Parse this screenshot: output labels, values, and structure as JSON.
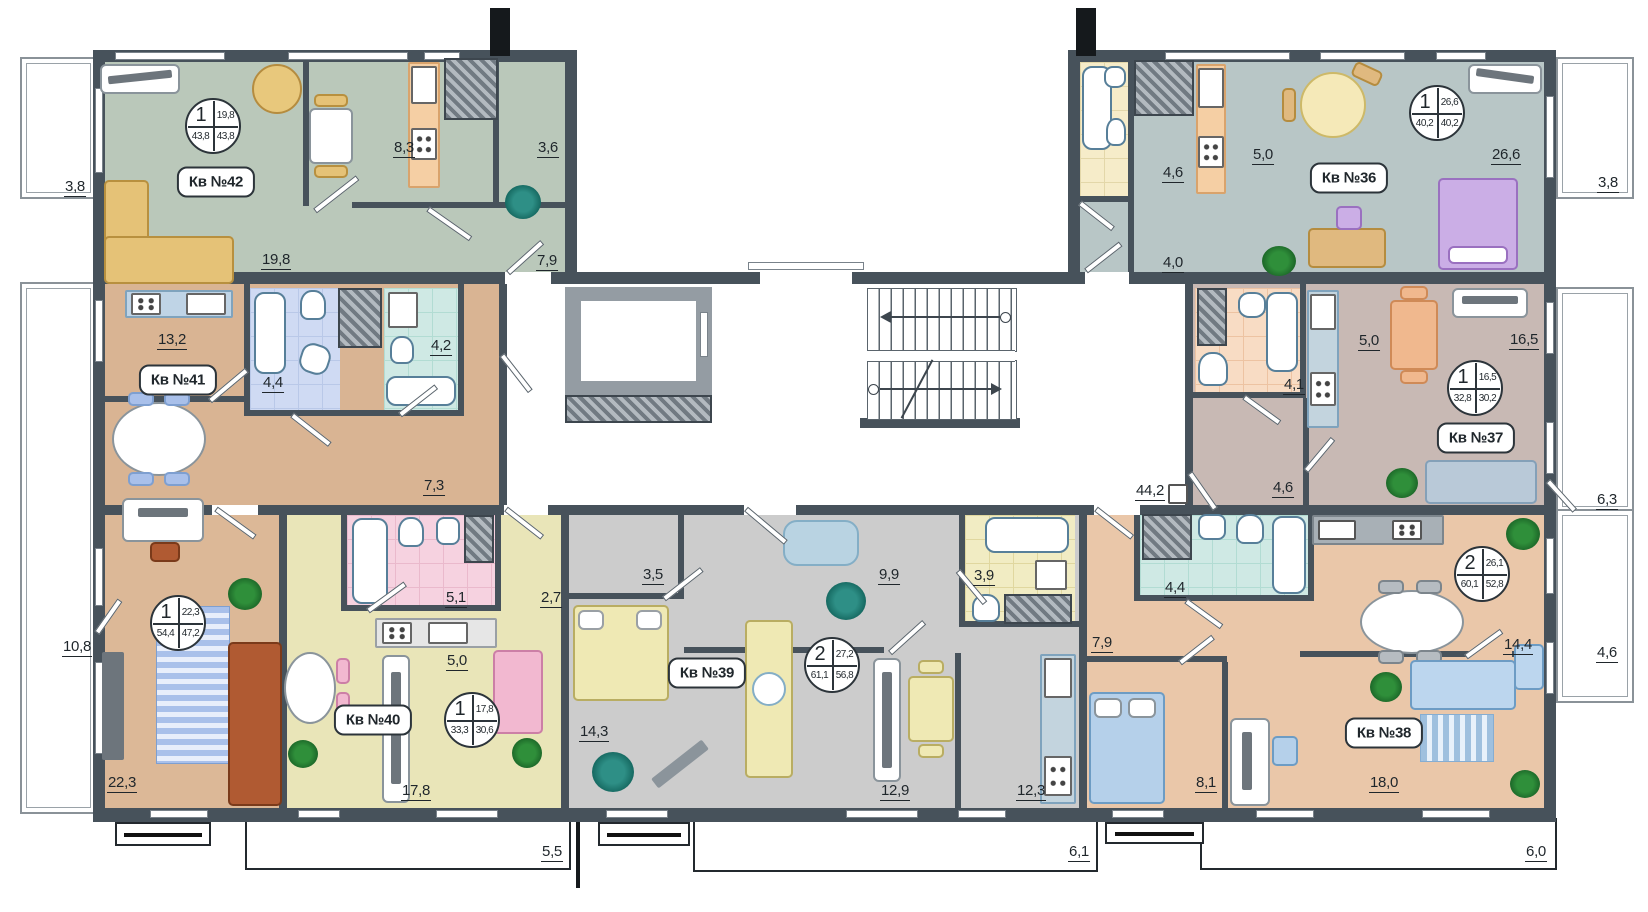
{
  "plan": {
    "title": "Floor plan with apartments 36-42",
    "colors": {
      "walls": "#47525b",
      "apt42_fill": "#bac8ba",
      "apt41_fill": "#d9b493",
      "apt40_fill": "#e9e5b8",
      "apt39_fill": "#cccccc",
      "apt38_fill": "#eac7a9",
      "apt37_fill": "#c8b9b4",
      "apt36_fill": "#b8c6c6"
    },
    "apartments": [
      {
        "badge": "Кв №42",
        "circle": {
          "rooms": "1",
          "living": "19,8",
          "total": "43,8",
          "reduced": "43,8"
        },
        "areas": {
          "living": "19,8",
          "kitchen": "8,3",
          "pantry": "3,6",
          "hall": "7,9"
        }
      },
      {
        "badge": "Кв №41",
        "circle": {
          "rooms": "1",
          "living": "22,3",
          "total": "54,4",
          "reduced": "47,2"
        },
        "areas": {
          "kitchen": "13,2",
          "bath": "4,4",
          "toilet": "4,2",
          "hall": "7,3",
          "living": "22,3"
        }
      },
      {
        "badge": "Кв №40",
        "circle": {
          "rooms": "1",
          "living": "17,8",
          "total": "33,3",
          "reduced": "30,6"
        },
        "areas": {
          "bath": "5,1",
          "hall": "2,7",
          "kitchen": "5,0",
          "living": "17,8"
        }
      },
      {
        "badge": "Кв №39",
        "circle": {
          "rooms": "2",
          "living": "27,2",
          "total": "61,1",
          "reduced": "56,8"
        },
        "areas": {
          "hall": "3,5",
          "corridor": "9,9",
          "bath": "3,9",
          "bedroom": "14,3",
          "living": "12,9",
          "kitchen": "12,3"
        }
      },
      {
        "badge": "Кв №38",
        "circle": {
          "rooms": "2",
          "living": "26,1",
          "total": "60,1",
          "reduced": "52,8"
        },
        "areas": {
          "hall": "7,9",
          "bath": "4,4",
          "kitchen": "14,4",
          "bedroom": "8,1",
          "living": "18,0"
        }
      },
      {
        "badge": "Кв №37",
        "circle": {
          "rooms": "1",
          "living": "16,5",
          "total": "32,8",
          "reduced": "30,2"
        },
        "areas": {
          "bath": "4,1",
          "kitchen": "5,0",
          "living": "16,5",
          "hall": "4,6"
        }
      },
      {
        "badge": "Кв №36",
        "circle": {
          "rooms": "1",
          "living": "26,6",
          "total": "40,2",
          "reduced": "40,2"
        },
        "areas": {
          "bath": "4,6",
          "kitchen": "5,0",
          "hall": "4,0",
          "living": "26,6"
        }
      }
    ],
    "common": {
      "corridor": "44,2"
    },
    "outside": {
      "balcony_left_top": "3,8",
      "balcony_left_bottom": "10,8",
      "balcony_right_top": "3,8",
      "balcony_right_mid": "6,3",
      "balcony_right_low": "4,6",
      "dim_bottom_left": "5,5",
      "dim_bottom_mid": "6,1",
      "dim_bottom_right": "6,0"
    }
  }
}
